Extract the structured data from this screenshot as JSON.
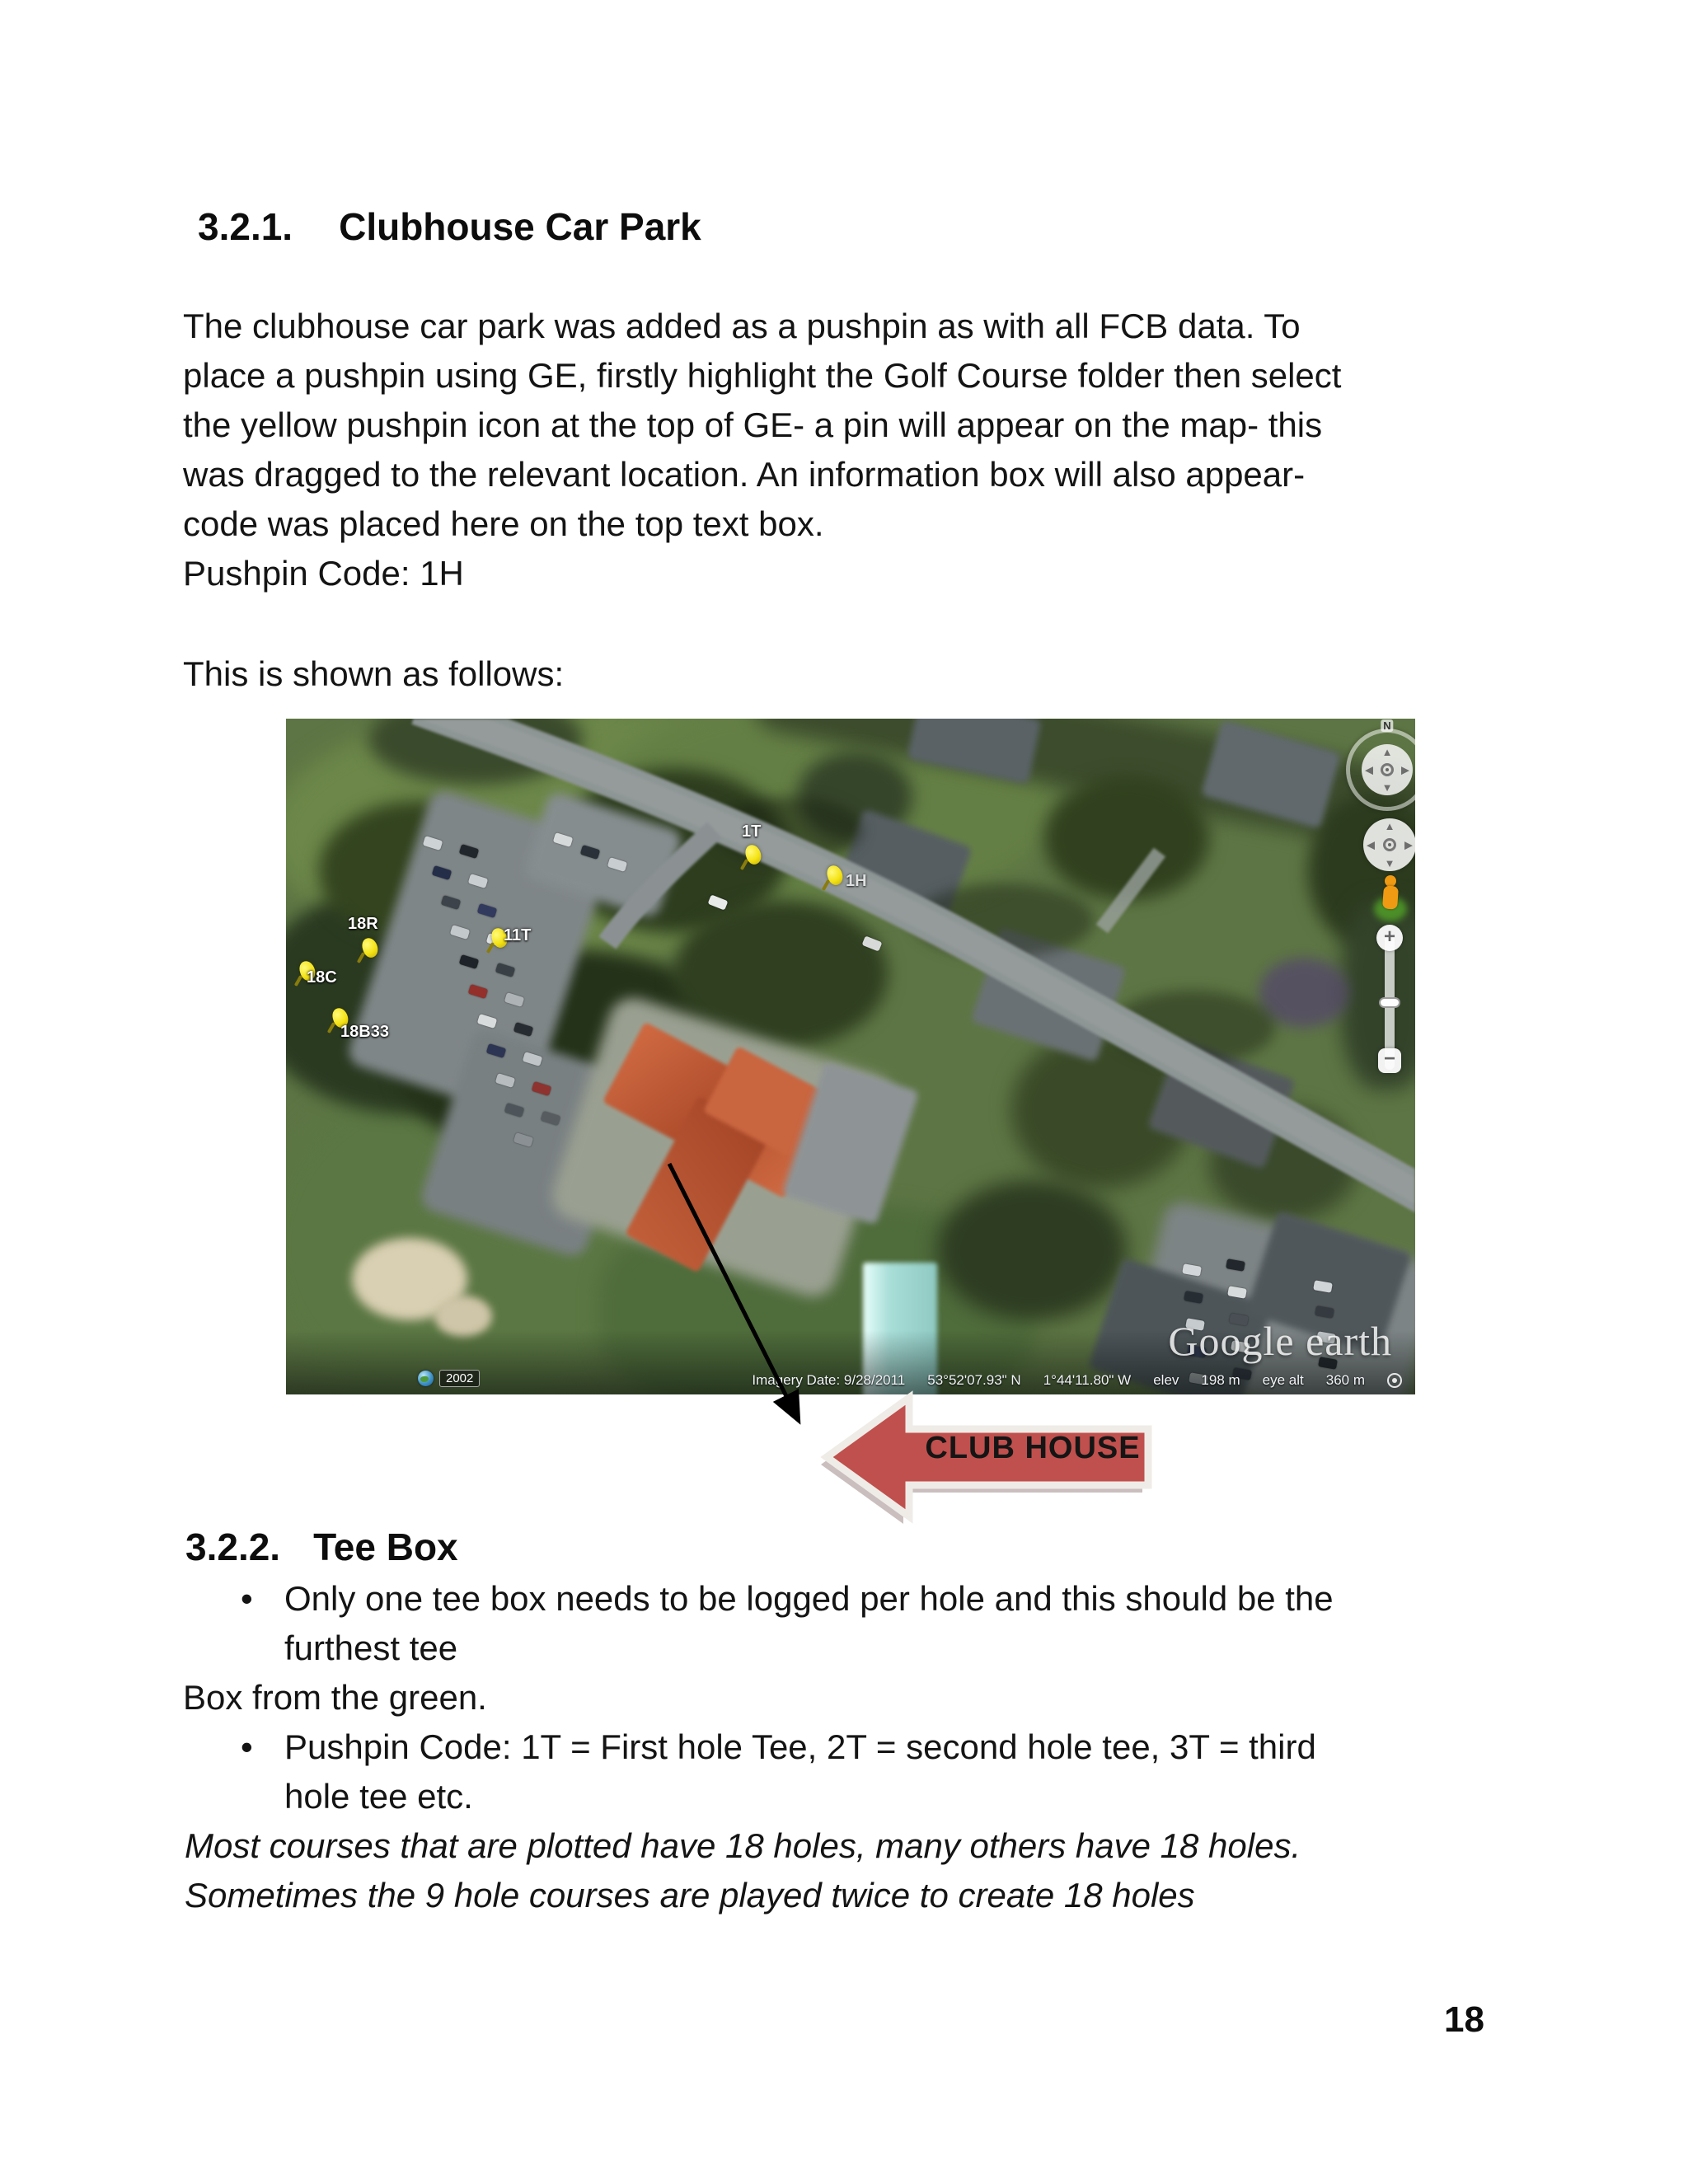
{
  "page_number": "18",
  "section_321": {
    "heading_number": "3.2.1.",
    "heading_title": "Clubhouse Car Park",
    "body_lines": [
      "The clubhouse car park was added as a pushpin as with all FCB data. To",
      "place a pushpin using GE, firstly highlight the Golf Course folder then select",
      "the yellow pushpin icon at the top of GE- a pin will appear on the map- this",
      "was dragged to the relevant location. An information box will also appear-",
      "code was placed here on the top text box.",
      "Pushpin Code: 1H"
    ],
    "intro_line": "This is shown as follows:"
  },
  "map": {
    "pushpins": [
      {
        "label": "1T"
      },
      {
        "label": "1H"
      },
      {
        "label": "11T"
      },
      {
        "label": "18R"
      },
      {
        "label": "18C"
      },
      {
        "label": "18B33"
      }
    ],
    "compass_n": "N",
    "zoom_in": "+",
    "zoom_out": "−",
    "watermark": "Google earth",
    "timeline_year": "2002",
    "status_items": [
      "Imagery Date: 9/28/2011",
      "53°52'07.93\" N",
      "1°44'11.80\" W",
      "elev",
      "198 m",
      "eye alt",
      "360 m"
    ]
  },
  "callout": {
    "label": "CLUB HOUSE",
    "fill_color": "#c0504d"
  },
  "section_322": {
    "heading_number": "3.2.2.",
    "heading_title": "Tee Box",
    "bullet_char": "•",
    "bullet_1_lines": [
      "Only one tee box needs to be logged per hole and this should be the",
      "furthest tee"
    ],
    "continuation_line": "Box from the green.",
    "bullet_2_lines": [
      "Pushpin Code: 1T = First hole Tee, 2T = second hole tee, 3T = third",
      "hole tee etc."
    ],
    "italic_lines": [
      "Most courses that are plotted have 18 holes, many others have 18 holes.",
      "Sometimes the 9 hole courses are played twice to create 18 holes"
    ]
  }
}
